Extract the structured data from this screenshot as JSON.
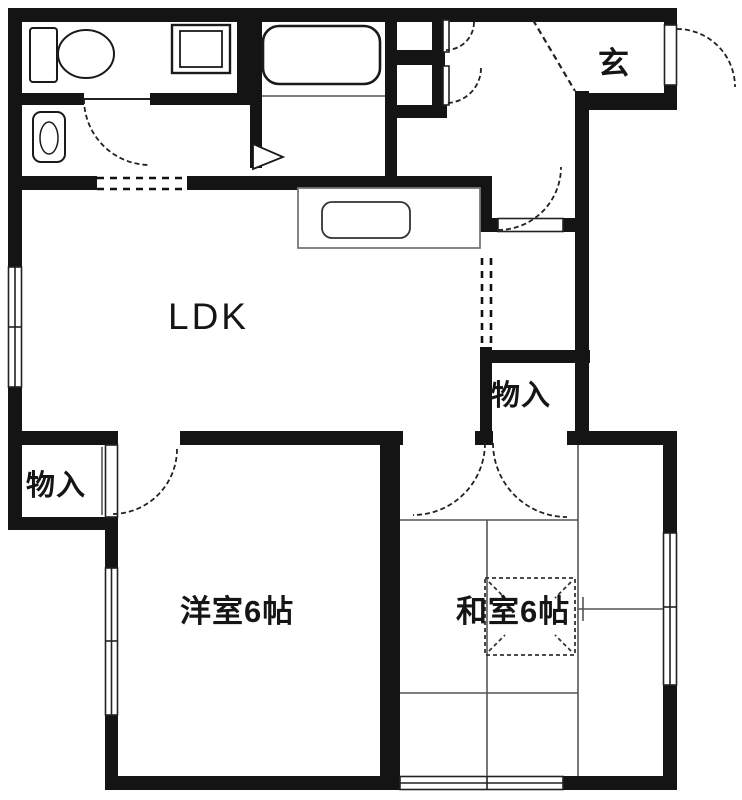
{
  "plan": {
    "title": "apartment-floor-plan-1ldk-2rooms",
    "labels": {
      "entrance": "玄",
      "ldk": "LDK",
      "storage_hall": "物入",
      "storage_west": "物入",
      "western_room": "洋室6帖",
      "japanese_room": "和室6帖"
    },
    "fixtures": [
      "toilet-icon",
      "washing-machine-icon",
      "washbasin-icon",
      "bathtub-icon",
      "kitchen-sink-icon"
    ],
    "colors": {
      "wall": "#141414",
      "line": "#3a3a3a",
      "grid": "#777777",
      "bg": "#ffffff"
    }
  }
}
